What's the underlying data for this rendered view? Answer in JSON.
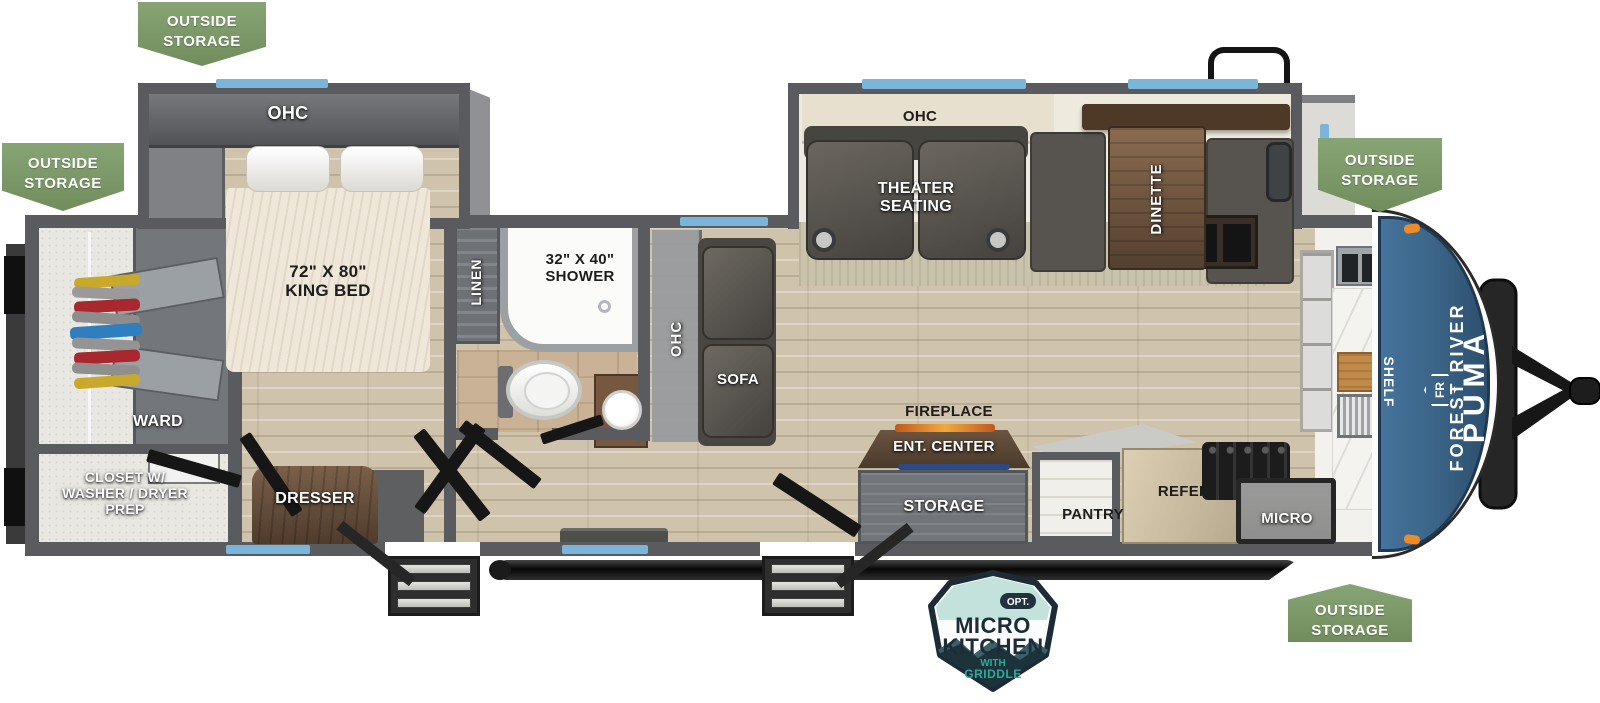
{
  "floorplan": {
    "title": "Forest River Puma travel trailer floor plan",
    "brand": {
      "maker": "FOREST RIVER",
      "model": "PUMA",
      "logo_text": "FR"
    },
    "storage_badge": {
      "text": "OUTSIDE\nSTORAGE"
    },
    "option_badge": {
      "opt": "OPT.",
      "title_line1": "MICRO",
      "title_line2": "KITCHEN",
      "subtitle_line1": "WITH",
      "subtitle_line2": "GRIDDLE"
    },
    "labels": {
      "bedroom_ohc": "OHC",
      "king_bed": "72\" X 80\"\nKING BED",
      "ward": "WARD",
      "closet": "CLOSET W/\nWASHER / DRYER\nPREP",
      "dresser": "DRESSER",
      "linen": "LINEN",
      "shower": "32\" X 40\"\nSHOWER",
      "hall_ohc": "OHC",
      "sofa": "SOFA",
      "theater_seating": "THEATER\nSEATING",
      "living_ohc": "OHC",
      "dinette": "DINETTE",
      "fireplace": "FIREPLACE",
      "ent_center": "ENT. CENTER",
      "storage": "STORAGE",
      "pantry": "PANTRY",
      "refer": "REFER",
      "micro": "MICRO",
      "shelf": "SHELF"
    },
    "colors": {
      "badge_green": "#7e9a6b",
      "cap_blue": "#3a6385",
      "window_blue": "#7cb5da",
      "wall_gray": "#5a5b5e",
      "floor_wood": "#d0c3ac",
      "badge_navy": "#1c2b36",
      "badge_teal": "#0f8e85",
      "marker_orange": "#ef8b25"
    }
  }
}
